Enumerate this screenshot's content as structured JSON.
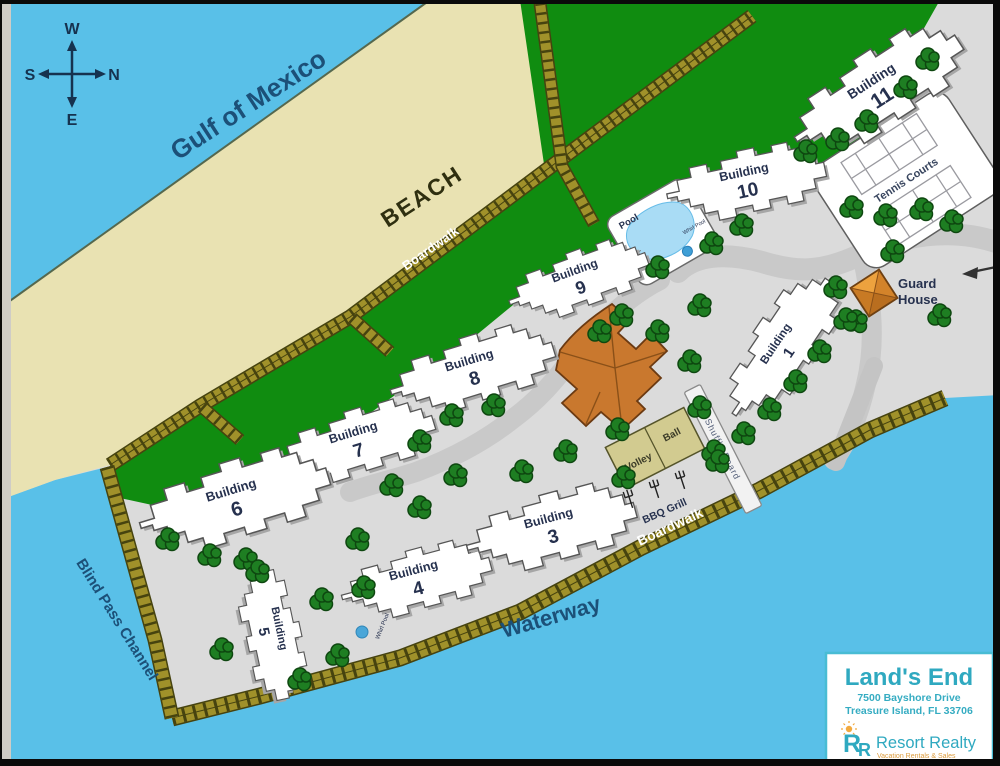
{
  "map": {
    "compass": {
      "top": "W",
      "right": "N",
      "left": "S",
      "bottom": "E"
    },
    "water_labels": {
      "gulf": "Gulf of Mexico",
      "channel": "Blind Pass Channel",
      "waterway": "Waterway"
    },
    "beach_label": "BEACH",
    "boardwalk_upper": "Boardwalk",
    "boardwalk_lower": "Boardwalk",
    "buildings": [
      {
        "label": "Building",
        "number": "11"
      },
      {
        "label": "Building",
        "number": "10"
      },
      {
        "label": "Building",
        "number": "9"
      },
      {
        "label": "Building",
        "number": "8"
      },
      {
        "label": "Building",
        "number": "7"
      },
      {
        "label": "Building",
        "number": "6"
      },
      {
        "label": "Building",
        "number": "5"
      },
      {
        "label": "Building",
        "number": "4"
      },
      {
        "label": "Building",
        "number": "3"
      },
      {
        "label": "Building",
        "number": "1"
      }
    ],
    "amenities": {
      "tennis": "Tennis Courts",
      "pool": "Pool",
      "pool_whirl": "Whirl Pool",
      "whirl_b5": "Whirl Pool",
      "guard_line1": "Guard",
      "guard_line2": "House",
      "shuffle": "Shuffle Board",
      "volley_left": "Volley",
      "volley_right": "Ball",
      "bbq": "BBQ Grill"
    },
    "colors": {
      "water": "#59c0e8",
      "beach": "#e9e2b2",
      "lawn": "#108c10",
      "grounds": "#dbdbdb",
      "boardwalk": "#9d8e24",
      "accent_teal": "#2fa9c0",
      "accent_orange": "#f0a83c"
    }
  },
  "info_box": {
    "title": "Land's End",
    "address_line1": "7500 Bayshore Drive",
    "address_line2": "Treasure Island, FL 33706",
    "brand": "Resort Realty",
    "tagline": "Vacation Rentals & Sales",
    "monogram_r1": "R",
    "monogram_r2": "R"
  }
}
